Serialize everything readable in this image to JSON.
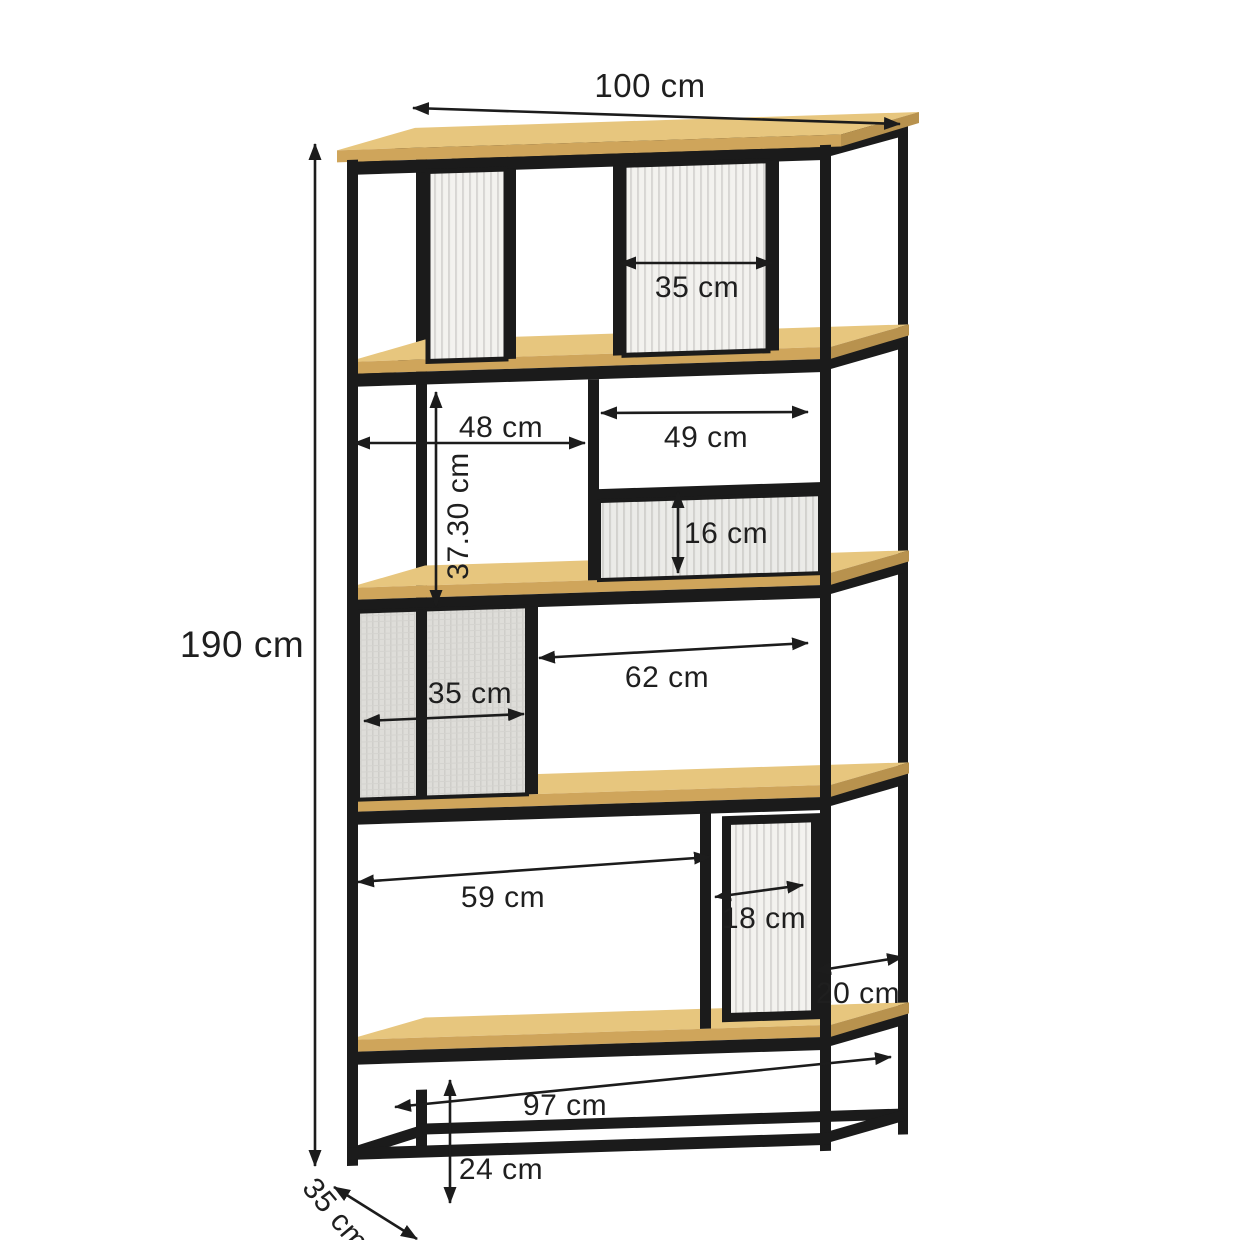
{
  "figure": {
    "kind": "furniture dimension diagram",
    "unit": "cm"
  },
  "colors": {
    "frame": "#1b1b1b",
    "wood_top": "#e7c67e",
    "wood_front": "#cfa55b",
    "wood_edge": "#b8924e",
    "glass_bg": "#f3f2ef",
    "glass_stripe": "#d7d6d3",
    "mesh_bg": "#deddd9",
    "gray_panel": "#ebebe8",
    "dimension_ink": "#1f1f1f"
  },
  "dimensions": [
    {
      "id": "total-width",
      "label": "100 cm"
    },
    {
      "id": "top-opening-width",
      "label": "35 cm"
    },
    {
      "id": "row2-left-width",
      "label": "48 cm"
    },
    {
      "id": "row2-right-width",
      "label": "49 cm"
    },
    {
      "id": "row2-height",
      "label": "37.30 cm"
    },
    {
      "id": "small-panel-height",
      "label": "16 cm"
    },
    {
      "id": "total-height",
      "label": "190 cm"
    },
    {
      "id": "mesh-panel-width",
      "label": "35 cm"
    },
    {
      "id": "row3-opening-width",
      "label": "62 cm"
    },
    {
      "id": "row4-opening-width",
      "label": "59 cm"
    },
    {
      "id": "door-glass-width",
      "label": "18 cm"
    },
    {
      "id": "side-gap-width",
      "label": "20 cm"
    },
    {
      "id": "base-width",
      "label": "97 cm"
    },
    {
      "id": "base-height",
      "label": "24 cm"
    },
    {
      "id": "depth",
      "label": "35 cm"
    }
  ]
}
